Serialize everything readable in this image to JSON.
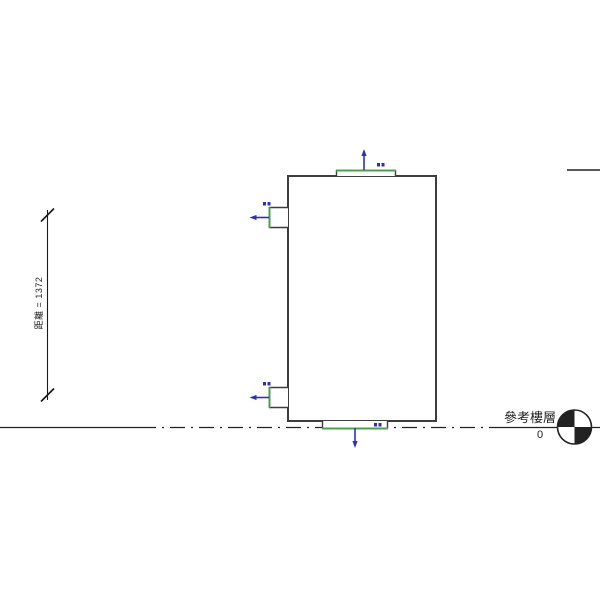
{
  "colors": {
    "line_dark": "#3d3d3d",
    "dimension_black": "#1a1a1a",
    "level_black": "#222222",
    "connector_green": "#4aa14a",
    "connector_blue": "#2e2ec4"
  },
  "annotations": {
    "dimension": {
      "label": "距離 = 1372"
    },
    "level": {
      "name": "參考樓層",
      "elevation": "0"
    }
  },
  "icons": {
    "level_symbol": "quadrant-circle",
    "dimension_ticks": "architectural-slash-ticks",
    "connector_arrows": "blue-flow-direction-arrows",
    "connector_tags": "small-blue-tag-marks"
  }
}
